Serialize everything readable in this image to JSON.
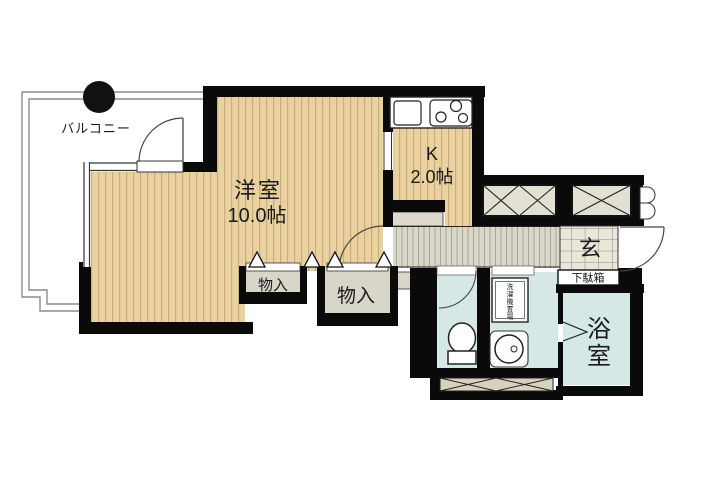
{
  "plan": {
    "type": "japanese-apartment-floorplan",
    "rooms": {
      "balcony": {
        "label": "バルコニー"
      },
      "western_room": {
        "label": "洋室",
        "size": "10.0帖"
      },
      "kitchen": {
        "label": "K",
        "size": "2.0帖"
      },
      "closet_left": {
        "label": "物入"
      },
      "closet_right": {
        "label": "物入"
      },
      "entrance": {
        "label": "玄"
      },
      "shoe_cabinet": {
        "label": "下駄箱"
      },
      "bathroom": {
        "label": "浴室",
        "chars": [
          "浴",
          "室"
        ]
      },
      "laundry": {
        "label": "洗濯機置場",
        "chars": [
          "洗",
          "濯",
          "機",
          "置",
          "場"
        ]
      }
    },
    "fixtures": [
      "kitchen-sink",
      "three-burner-stove",
      "toilet",
      "round-washbasin",
      "washing-machine-space",
      "storage-boxes-crossed",
      "entrance-door-swing",
      "room-door-swing",
      "balcony-door-swing",
      "folding-door-triangles"
    ],
    "colors": {
      "wall": "#0a0a0a",
      "room_floor": "#e9d2a0",
      "room_stripe": "#c9ad7c",
      "corridor_floor": "#d9d6ca",
      "corridor_stripe": "#a9a69c",
      "wet_area": "#d5e8e5",
      "closet_fill": "#d8d5c9",
      "storage_box_fill": "#e2e0d2",
      "entrance_tile": "#eae6d9",
      "hatch_fill": "#d7d1bf",
      "balcony_line": "#8c8c8c"
    }
  }
}
